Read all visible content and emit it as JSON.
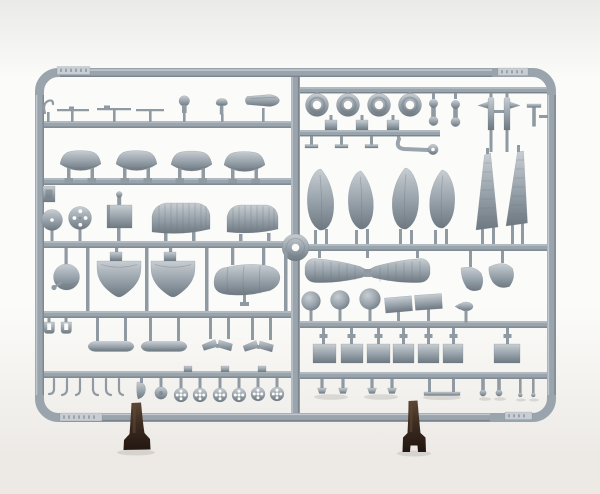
{
  "image": {
    "subject": "Photograph of a grey injection-molded plastic model kit sprue holding aircraft parts, standing upright on two small dark brown stands against a white background"
  },
  "colors": {
    "background_top": "#eaeae8",
    "background_mid": "#fbfbf9",
    "background_bottom": "#edeae6",
    "plastic": "#9aa4ac",
    "plastic_mid": "#909aa2",
    "plastic_light": "#c8ced3",
    "plastic_dark": "#6e7880",
    "shadow": "#b4b1ac",
    "stand_light": "#5f4735",
    "stand": "#3d2c21",
    "stand_dark": "#221711"
  },
  "sprue": {
    "frame": "rounded rectangular runner frame with centre spine, moulding plates and crossing hub",
    "part_groups": [
      {
        "name": "tires",
        "count": 4
      },
      {
        "name": "fuel-tank-halves",
        "count": 4
      },
      {
        "name": "wheel-discs",
        "count": 2
      },
      {
        "name": "radiator-box",
        "count": 1
      },
      {
        "name": "tailplane-halves",
        "count": 2
      },
      {
        "name": "cowling-dome",
        "count": 1
      },
      {
        "name": "intake-scoops",
        "count": 2
      },
      {
        "name": "fuselage-pod",
        "count": 1
      },
      {
        "name": "wheel-spat-halves",
        "count": 4
      },
      {
        "name": "ribbed-wing-panels",
        "count": 2
      },
      {
        "name": "lower-wing",
        "count": 1
      },
      {
        "name": "flap-fairings",
        "count": 2
      },
      {
        "name": "balls",
        "count": 3
      },
      {
        "name": "hatch-plates",
        "count": 9
      },
      {
        "name": "spoked-wheels",
        "count": 6
      },
      {
        "name": "struts-and-rods",
        "count": 7
      },
      {
        "name": "small-fittings",
        "count": 30
      }
    ]
  },
  "stands": {
    "count": 2,
    "color_name": "dark brown"
  }
}
